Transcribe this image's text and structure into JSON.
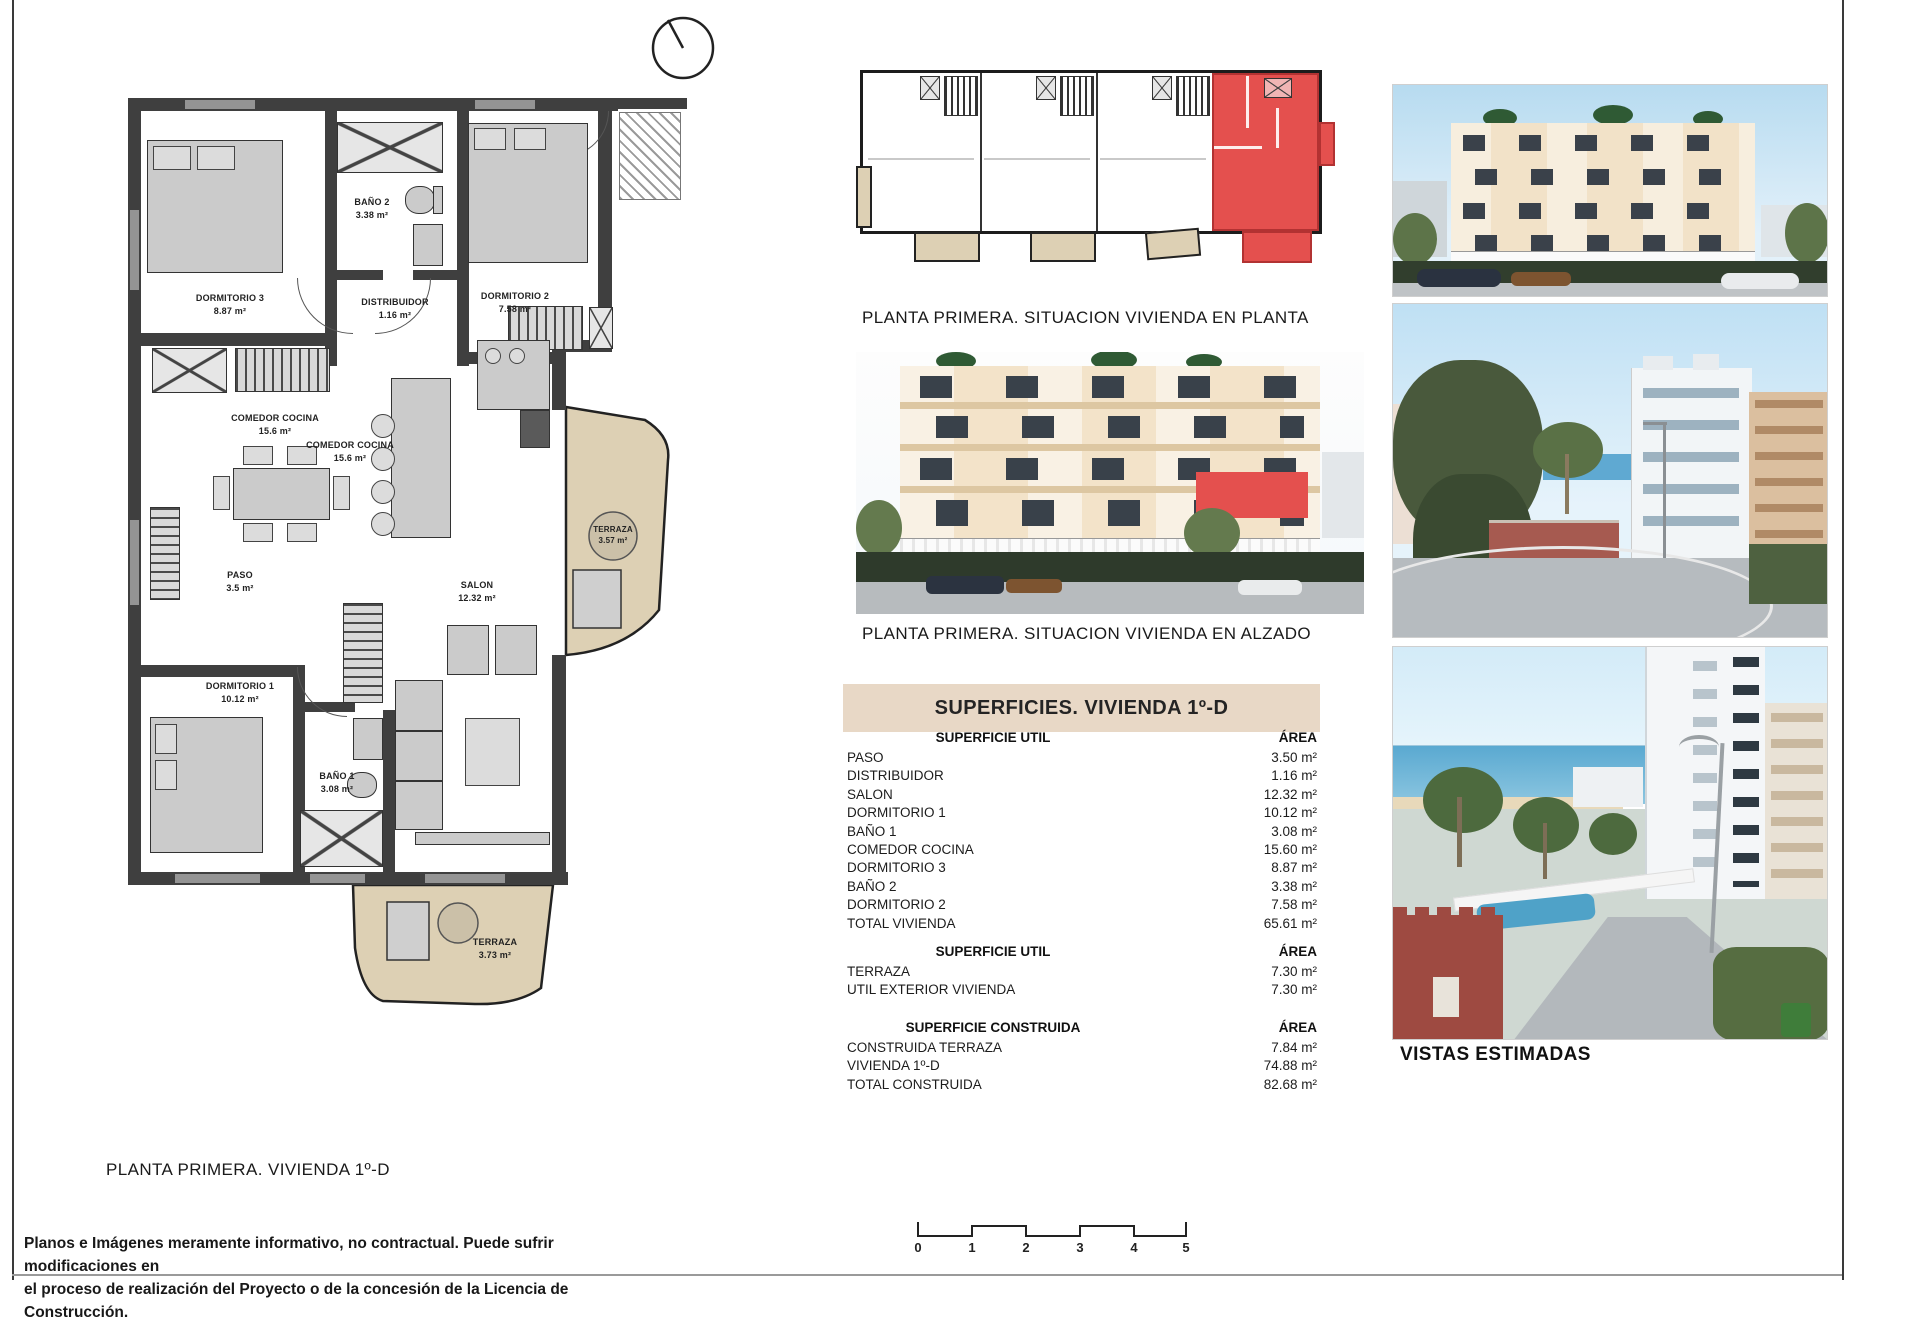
{
  "floor_plan": {
    "caption": "PLANTA PRIMERA. VIVIENDA 1º-D",
    "rooms": [
      {
        "name": "DORMITORIO 3",
        "area": "8.87 m²"
      },
      {
        "name": "BAÑO 2",
        "area": "3.38 m²"
      },
      {
        "name": "DISTRIBUIDOR",
        "area": "1.16 m²"
      },
      {
        "name": "DORMITORIO 2",
        "area": "7.58 m²"
      },
      {
        "name": "COMEDOR COCINA",
        "area": "15.6 m²"
      },
      {
        "name": "COMEDOR COCINA",
        "area": "15.6 m²"
      },
      {
        "name": "PASO",
        "area": "3.5 m²"
      },
      {
        "name": "SALON",
        "area": "12.32 m²"
      },
      {
        "name": "TERRAZA",
        "area": "3.57 m²"
      },
      {
        "name": "DORMITORIO 1",
        "area": "10.12 m²"
      },
      {
        "name": "BAÑO 1",
        "area": "3.08 m²"
      },
      {
        "name": "TERRAZA",
        "area": "3.73 m²"
      }
    ]
  },
  "situation_plan": {
    "caption": "PLANTA PRIMERA. SITUACION VIVIENDA EN PLANTA"
  },
  "elevation": {
    "caption": "PLANTA PRIMERA. SITUACION VIVIENDA EN ALZADO"
  },
  "surfaces": {
    "title": "SUPERFICIES. VIVIENDA 1º-D",
    "sections": [
      {
        "header": "SUPERFICIE UTIL",
        "area_header": "ÁREA",
        "rows": [
          {
            "label": "PASO",
            "value": "3.50 m²"
          },
          {
            "label": "DISTRIBUIDOR",
            "value": "1.16 m²"
          },
          {
            "label": "SALON",
            "value": "12.32 m²"
          },
          {
            "label": "DORMITORIO 1",
            "value": "10.12 m²"
          },
          {
            "label": "BAÑO 1",
            "value": "3.08 m²"
          },
          {
            "label": "COMEDOR COCINA",
            "value": "15.60 m²"
          },
          {
            "label": "DORMITORIO 3",
            "value": "8.87 m²"
          },
          {
            "label": "BAÑO 2",
            "value": "3.38 m²"
          },
          {
            "label": "DORMITORIO 2",
            "value": "7.58 m²"
          },
          {
            "label": "TOTAL VIVIENDA",
            "value": "65.61 m²"
          }
        ]
      },
      {
        "header": "SUPERFICIE UTIL",
        "area_header": "ÁREA",
        "rows": [
          {
            "label": "TERRAZA",
            "value": "7.30 m²"
          },
          {
            "label": "UTIL EXTERIOR VIVIENDA",
            "value": "7.30 m²"
          }
        ]
      },
      {
        "header": "SUPERFICIE CONSTRUIDA",
        "area_header": "ÁREA",
        "rows": [
          {
            "label": "CONSTRUIDA TERRAZA",
            "value": "7.84 m²"
          },
          {
            "label": "VIVIENDA 1º-D",
            "value": "74.88 m²"
          },
          {
            "label": "TOTAL CONSTRUIDA",
            "value": "82.68 m²"
          }
        ]
      }
    ]
  },
  "views": {
    "caption": "VISTAS ESTIMADAS"
  },
  "scale_bar": {
    "labels": [
      "0",
      "1",
      "2",
      "3",
      "4",
      "5"
    ]
  },
  "disclaimer": {
    "line1": "Planos e Imágenes meramente informativo, no contractual. Puede sufrir modificaciones en",
    "line2": "el proceso de realización del Proyecto o de la concesión de la Licencia de Construcción."
  },
  "colors": {
    "highlight_red": "#e4504e",
    "terrace_beige": "#ddd0b4",
    "table_band_beige": "#e8d8c6"
  },
  "icons": {
    "north": "north-indicator"
  }
}
